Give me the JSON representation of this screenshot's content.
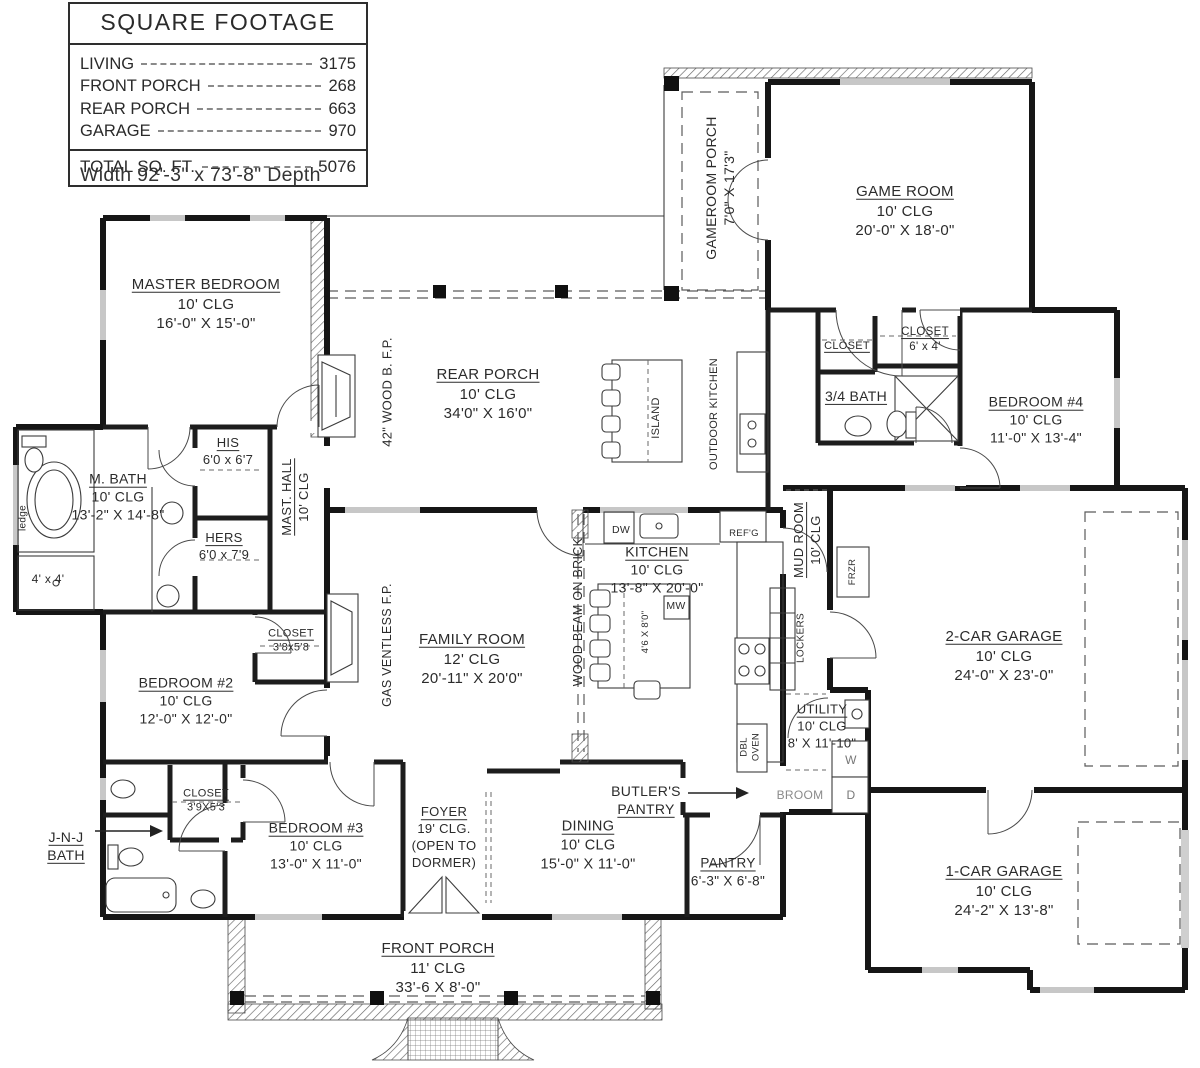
{
  "title_block": {
    "title": "SQUARE FOOTAGE",
    "rows": [
      {
        "label": "LIVING",
        "value": "3175"
      },
      {
        "label": "FRONT PORCH",
        "value": "268"
      },
      {
        "label": "REAR PORCH",
        "value": "663"
      },
      {
        "label": "GARAGE",
        "value": "970"
      }
    ],
    "total": {
      "label": "TOTAL SQ. FT.",
      "value": "5076"
    },
    "note": "Width 92'-3\" x 73'-8\" Depth"
  },
  "plan": {
    "labels": [
      {
        "id": "master-bedroom",
        "lines": [
          "MASTER BEDROOM",
          "10' CLG",
          "16'-0\" X 15'-0\""
        ],
        "x": 206,
        "y": 304,
        "fs": 15,
        "ul": [
          0
        ]
      },
      {
        "id": "m-bath",
        "lines": [
          "M. BATH",
          "10' CLG",
          "13'-2\" X 14'-8\""
        ],
        "x": 118,
        "y": 497,
        "fs": 14,
        "ul": [
          0
        ]
      },
      {
        "id": "his-closet",
        "lines": [
          "HIS",
          "6'0 x 6'7"
        ],
        "x": 228,
        "y": 452,
        "fs": 13,
        "ul": [
          0
        ]
      },
      {
        "id": "hers-closet",
        "lines": [
          "HERS",
          "6'0 x 7'9"
        ],
        "x": 224,
        "y": 547,
        "fs": 13,
        "ul": [
          0
        ]
      },
      {
        "id": "shower",
        "lines": [
          "4' x 4'"
        ],
        "x": 48,
        "y": 580,
        "fs": 12
      },
      {
        "id": "ledge",
        "lines": [
          "ledge"
        ],
        "x": 23,
        "y": 518,
        "fs": 10,
        "rot": true
      },
      {
        "id": "mast-hall",
        "lines": [
          "MAST. HALL",
          "10' CLG"
        ],
        "x": 296,
        "y": 497,
        "fs": 13,
        "rot": true,
        "ul": [
          0
        ]
      },
      {
        "id": "wood-fp",
        "lines": [
          "42\" WOOD B. F.P."
        ],
        "x": 388,
        "y": 392,
        "fs": 13,
        "rot": true
      },
      {
        "id": "rear-porch",
        "lines": [
          "REAR PORCH",
          "10' CLG",
          "34'0\" X 16'0\""
        ],
        "x": 488,
        "y": 394,
        "fs": 15,
        "ul": [
          0
        ]
      },
      {
        "id": "island-porch",
        "lines": [
          "ISLAND"
        ],
        "x": 656,
        "y": 418,
        "fs": 11,
        "rot": true
      },
      {
        "id": "outdoor-kitchen",
        "lines": [
          "OUTDOOR KITCHEN"
        ],
        "x": 714,
        "y": 414,
        "fs": 11,
        "rot": true
      },
      {
        "id": "gameroom-porch",
        "lines": [
          "GAMEROOM PORCH",
          "7'0\" X 17'3\""
        ],
        "x": 720,
        "y": 188,
        "fs": 14,
        "rot": true
      },
      {
        "id": "game-room",
        "lines": [
          "GAME ROOM",
          "10' CLG",
          "20'-0\" X 18'-0\""
        ],
        "x": 905,
        "y": 211,
        "fs": 15,
        "ul": [
          0
        ]
      },
      {
        "id": "closet-gameroom",
        "lines": [
          "CLOSET"
        ],
        "x": 847,
        "y": 346,
        "fs": 11,
        "ul": [
          0
        ]
      },
      {
        "id": "closet-6x4",
        "lines": [
          "CLOSET",
          "6' x 4'"
        ],
        "x": 925,
        "y": 340,
        "fs": 11.5,
        "ul": [
          0
        ]
      },
      {
        "id": "bath-34",
        "lines": [
          "3/4 BATH"
        ],
        "x": 856,
        "y": 396,
        "fs": 14,
        "ul": [
          0
        ]
      },
      {
        "id": "bedroom-4",
        "lines": [
          "BEDROOM #4",
          "10' CLG",
          "11'-0\" X 13'-4\""
        ],
        "x": 1036,
        "y": 420,
        "fs": 14,
        "ul": [
          0
        ]
      },
      {
        "id": "mud-room",
        "lines": [
          "MUD ROOM",
          "10' CLG"
        ],
        "x": 808,
        "y": 540,
        "fs": 13,
        "rot": true,
        "ul": [
          0
        ]
      },
      {
        "id": "frzr",
        "lines": [
          "FRZR"
        ],
        "x": 853,
        "y": 572,
        "fs": 9.5,
        "rot": true
      },
      {
        "id": "lockers",
        "lines": [
          "LOCKERS"
        ],
        "x": 801,
        "y": 638,
        "fs": 10,
        "rot": true
      },
      {
        "id": "kitchen",
        "lines": [
          "KITCHEN",
          "10' CLG",
          "13'-8\" X 20'-0\""
        ],
        "x": 657,
        "y": 570,
        "fs": 14,
        "ul": [
          0
        ]
      },
      {
        "id": "mw",
        "lines": [
          "MW"
        ],
        "x": 676,
        "y": 607,
        "fs": 10.5
      },
      {
        "id": "dw",
        "lines": [
          "DW"
        ],
        "x": 621,
        "y": 531,
        "fs": 10.5
      },
      {
        "id": "refg",
        "lines": [
          "REF'G"
        ],
        "x": 744,
        "y": 534,
        "fs": 9.5
      },
      {
        "id": "island-dims",
        "lines": [
          "4'6 X 8'0\""
        ],
        "x": 646,
        "y": 632,
        "fs": 9.5,
        "rot": true
      },
      {
        "id": "wood-beam",
        "lines": [
          "WOOD BEAM ON BRICK"
        ],
        "x": 578,
        "y": 612,
        "fs": 12.5,
        "rot": true
      },
      {
        "id": "gas-fp",
        "lines": [
          "GAS VENTLESS F.P."
        ],
        "x": 387,
        "y": 645,
        "fs": 12.5,
        "rot": true
      },
      {
        "id": "family-room",
        "lines": [
          "FAMILY ROOM",
          "12' CLG",
          "20'-11\" X 20'0\""
        ],
        "x": 472,
        "y": 659,
        "fs": 15,
        "ul": [
          0
        ]
      },
      {
        "id": "bedroom-2",
        "lines": [
          "BEDROOM #2",
          "10' CLG",
          "12'-0\" X 12'-0\""
        ],
        "x": 186,
        "y": 701,
        "fs": 14,
        "ul": [
          0
        ]
      },
      {
        "id": "closet-bedroom2",
        "lines": [
          "CLOSET",
          "3'8x5'8"
        ],
        "x": 291,
        "y": 641,
        "fs": 11,
        "ul": [
          0
        ]
      },
      {
        "id": "utility",
        "lines": [
          "UTILITY",
          "10' CLG",
          "8' X 11'-10\""
        ],
        "x": 822,
        "y": 727,
        "fs": 13,
        "ul": [
          0
        ]
      },
      {
        "id": "dbl-oven",
        "lines": [
          "DBL",
          "OVEN"
        ],
        "x": 751,
        "y": 747,
        "fs": 9.5,
        "rot": true
      },
      {
        "id": "broom",
        "lines": [
          "BROOM"
        ],
        "x": 800,
        "y": 796,
        "fs": 12,
        "color": "#8a8a8a"
      },
      {
        "id": "washer",
        "lines": [
          "W"
        ],
        "x": 851,
        "y": 761,
        "fs": 12,
        "color": "#777"
      },
      {
        "id": "dryer",
        "lines": [
          "D"
        ],
        "x": 851,
        "y": 796,
        "fs": 12,
        "color": "#777"
      },
      {
        "id": "garage-2car",
        "lines": [
          "2-CAR GARAGE",
          "10' CLG",
          "24'-0\" X 23'-0\""
        ],
        "x": 1004,
        "y": 656,
        "fs": 15,
        "ul": [
          0
        ]
      },
      {
        "id": "garage-1car",
        "lines": [
          "1-CAR GARAGE",
          "10' CLG",
          "24'-2\" X 13'-8\""
        ],
        "x": 1004,
        "y": 891,
        "fs": 15,
        "ul": [
          0
        ]
      },
      {
        "id": "jnj-bath",
        "lines": [
          "J-N-J",
          "BATH"
        ],
        "x": 66,
        "y": 846,
        "fs": 14,
        "ul": [
          0,
          1
        ]
      },
      {
        "id": "closet-bedroom3",
        "lines": [
          "CLOSET",
          "3'9X5'3"
        ],
        "x": 206,
        "y": 801,
        "fs": 11,
        "ul": [
          0
        ]
      },
      {
        "id": "bedroom-3",
        "lines": [
          "BEDROOM #3",
          "10' CLG",
          "13'-0\" X 11'-0\""
        ],
        "x": 316,
        "y": 846,
        "fs": 14,
        "ul": [
          0
        ]
      },
      {
        "id": "foyer",
        "lines": [
          "FOYER",
          "19' CLG.",
          "(OPEN TO",
          "DORMER)"
        ],
        "x": 444,
        "y": 838,
        "fs": 13,
        "ul": [
          0
        ]
      },
      {
        "id": "dining",
        "lines": [
          "DINING",
          "10' CLG",
          "15'-0\" X 11'-0\""
        ],
        "x": 588,
        "y": 846,
        "fs": 14.5,
        "ul": [
          0
        ]
      },
      {
        "id": "butlers-pantry",
        "lines": [
          "BUTLER'S",
          "PANTRY"
        ],
        "x": 646,
        "y": 800,
        "fs": 14,
        "ul": [
          1
        ]
      },
      {
        "id": "pantry",
        "lines": [
          "PANTRY",
          "6'-3\" X 6'-8\""
        ],
        "x": 728,
        "y": 872,
        "fs": 13.5,
        "ul": [
          0
        ]
      },
      {
        "id": "front-porch",
        "lines": [
          "FRONT PORCH",
          "11' CLG",
          "33'-6 X 8'-0\""
        ],
        "x": 438,
        "y": 968,
        "fs": 15,
        "ul": [
          0
        ]
      }
    ]
  }
}
